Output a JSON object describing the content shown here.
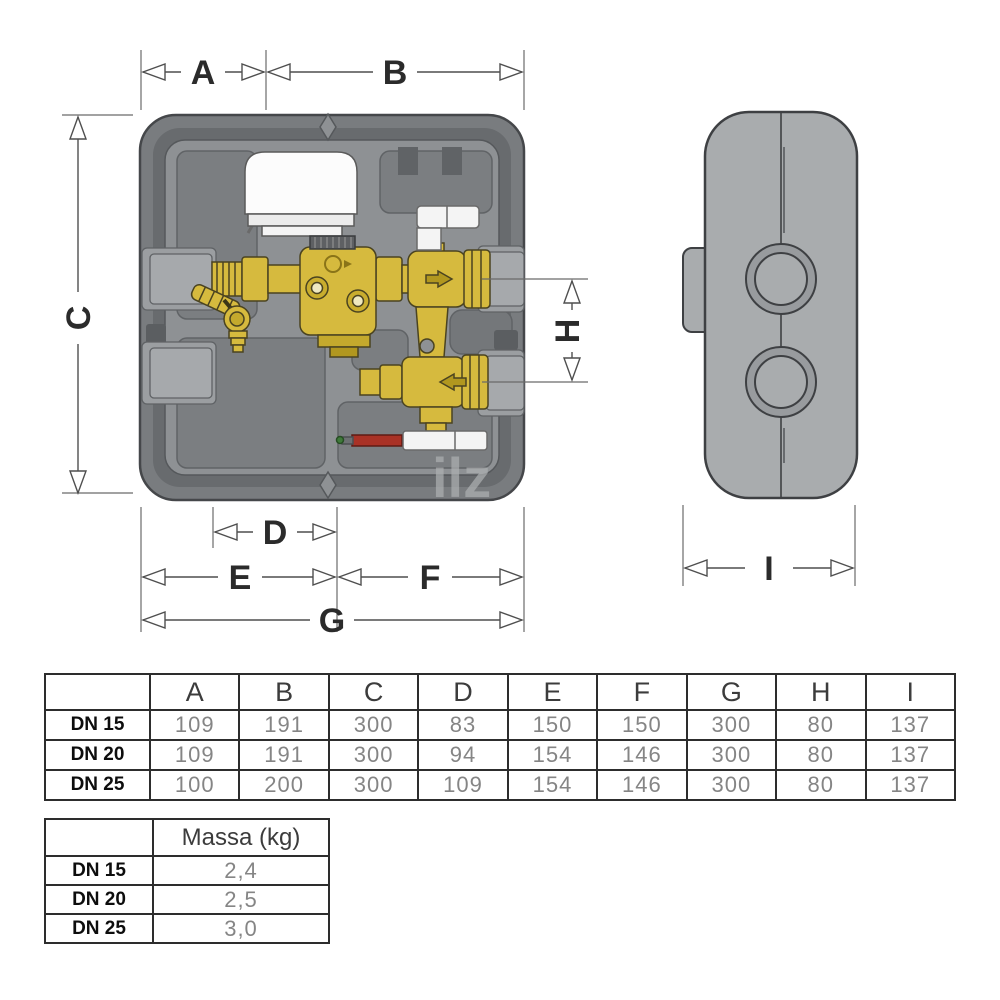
{
  "diagram": {
    "dim_labels": {
      "a": "A",
      "b": "B",
      "c": "C",
      "d": "D",
      "e": "E",
      "f": "F",
      "g": "G",
      "h": "H",
      "i": "I"
    },
    "watermark": "ilz"
  },
  "dimensions_table": {
    "columns": [
      "A",
      "B",
      "C",
      "D",
      "E",
      "F",
      "G",
      "H",
      "I"
    ],
    "rows": [
      {
        "label": "DN 15",
        "values": [
          "109",
          "191",
          "300",
          "83",
          "150",
          "150",
          "300",
          "80",
          "137"
        ]
      },
      {
        "label": "DN 20",
        "values": [
          "109",
          "191",
          "300",
          "94",
          "154",
          "146",
          "300",
          "80",
          "137"
        ]
      },
      {
        "label": "DN 25",
        "values": [
          "100",
          "200",
          "300",
          "109",
          "154",
          "146",
          "300",
          "80",
          "137"
        ]
      }
    ]
  },
  "mass_table": {
    "header": "Massa (kg)",
    "rows": [
      {
        "label": "DN 15",
        "value": "2,4"
      },
      {
        "label": "DN 20",
        "value": "2,5"
      },
      {
        "label": "DN 25",
        "value": "3,0"
      }
    ]
  },
  "colors": {
    "box_outer_gray": "#797c7f",
    "box_ring_gray": "#686b6e",
    "box_cavity_gray": "#8e9194",
    "side_view_gray": "#a9acae",
    "brass": "#d6ba3e",
    "brass_dark": "#b1971f",
    "actuator_white": "#fcfcfc",
    "probe_red": "#a93226",
    "dimension_line": "#4f4f4f"
  }
}
